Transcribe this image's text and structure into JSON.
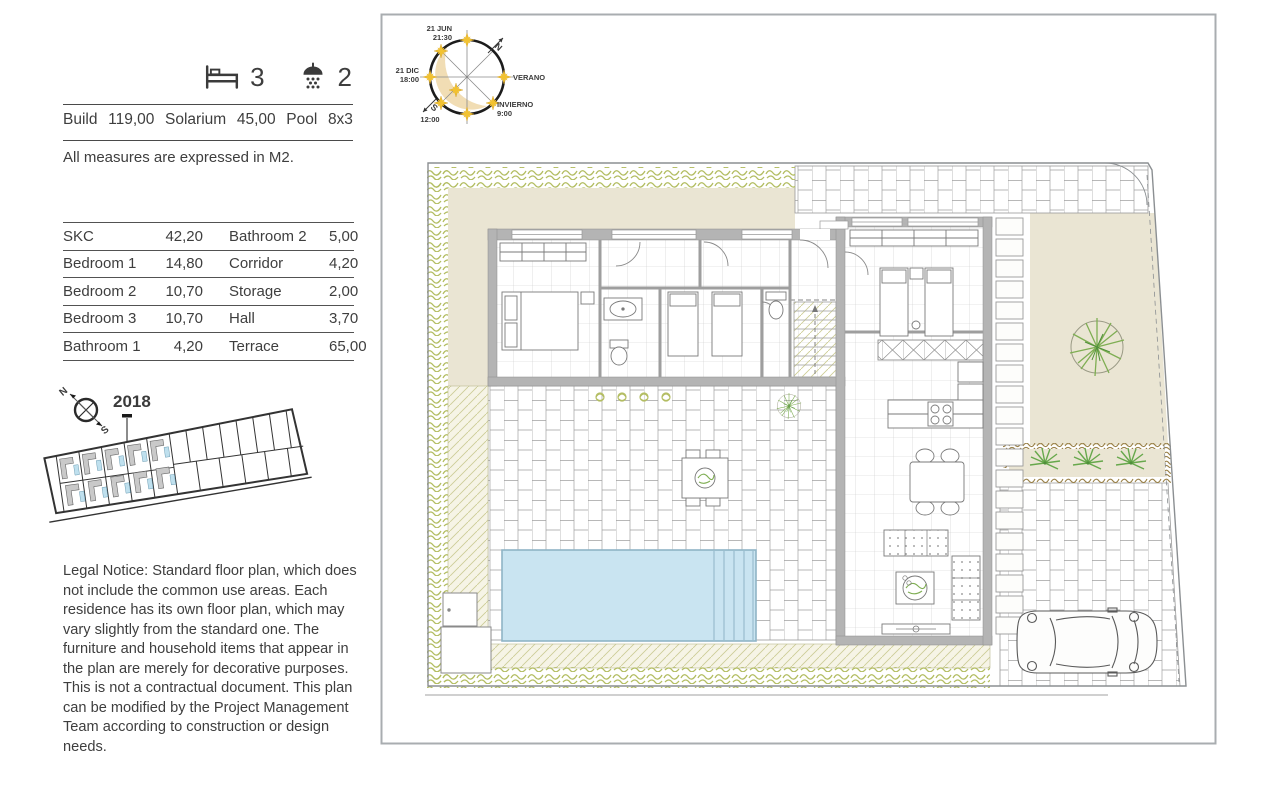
{
  "specs": {
    "bedrooms": "3",
    "bathrooms": "2",
    "build_label": "Build",
    "build_value": "119,00",
    "solarium_label": "Solarium",
    "solarium_value": "45,00",
    "pool_label": "Pool",
    "pool_value": "8x3",
    "measures_note": "All measures are expressed in M2."
  },
  "areas_table": {
    "rows": [
      {
        "l": "SKC",
        "lv": "42,20",
        "r": "Bathroom 2",
        "rv": "5,00"
      },
      {
        "l": "Bedroom 1",
        "lv": "14,80",
        "r": "Corridor",
        "rv": "4,20"
      },
      {
        "l": "Bedroom 2",
        "lv": "10,70",
        "r": "Storage",
        "rv": "2,00"
      },
      {
        "l": "Bedroom 3",
        "lv": "10,70",
        "r": "Hall",
        "rv": "3,70"
      },
      {
        "l": "Bathroom 1",
        "lv": "4,20",
        "r": "Terrace",
        "rv": "65,00"
      }
    ]
  },
  "site_plan": {
    "year": "2018",
    "north": "N",
    "south": "S"
  },
  "sun_diagram": {
    "date_summer": "21 JUN",
    "time_summer": "21:30",
    "date_winter": "21 DIC",
    "time_winter": "18:00",
    "north": "N",
    "south": "S",
    "noon": "12:00",
    "summer": "VERANO",
    "winter": "INVIERNO",
    "sunrise_winter": "9:00"
  },
  "legal_notice": "Legal Notice: Standard floor plan, which does not include the common use areas. Each residence has its own floor plan, which may vary slightly from the standard one. The furniture and household items that appear in the plan are merely for decorative purposes. This is not a contractual document. This plan can be modified by the Project Management Team according to construction or design needs.",
  "colors": {
    "ink": "#3e3e3e",
    "beige": "#eae5d3",
    "pool": "#c9e4f1",
    "pooledge": "#8fb4c6",
    "hedge": "#b3bd62",
    "planter": "#9a8147",
    "tree": "#7fae53",
    "palm": "#67a84c",
    "sun": "#f2c230",
    "wall": "#b4b4b4",
    "crescent": "#f1ddb4",
    "diag": "#cdcd96",
    "panel": "#a9adb0",
    "line": "#9b9b9b",
    "sitepool": "#bfe0ee",
    "building": "#c9c9c9"
  }
}
